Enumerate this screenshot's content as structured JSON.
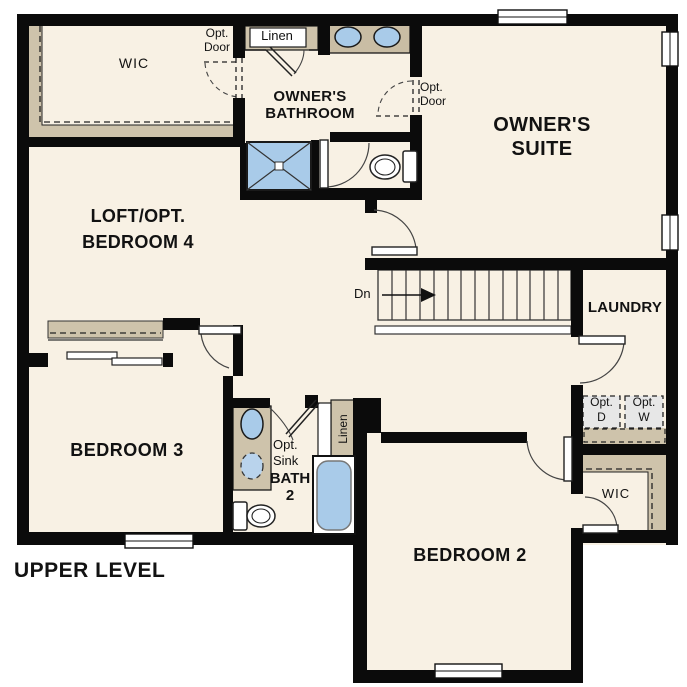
{
  "plan_title": "UPPER LEVEL",
  "colors": {
    "floor": "#f8f1e4",
    "wall": "#0b0b0b",
    "shelf_tan": "#cec3ab",
    "fixture_blue": "#a9cbe9",
    "optional_gray": "#e7e7e7",
    "outside": "#ffffff"
  },
  "rooms": {
    "wic_owners": {
      "label": "WIC"
    },
    "owners_bathroom": {
      "line1": "OWNER'S",
      "line2": "BATHROOM"
    },
    "owners_suite": {
      "line1": "OWNER'S",
      "line2": "SUITE"
    },
    "loft": {
      "line1": "LOFT/OPT.",
      "line2": "BEDROOM 4"
    },
    "laundry": {
      "label": "LAUNDRY"
    },
    "bedroom3": {
      "label": "BEDROOM 3"
    },
    "bath2": {
      "line1": "BATH",
      "line2": "2"
    },
    "bedroom2": {
      "label": "BEDROOM 2"
    },
    "wic_bedroom2": {
      "label": "WIC"
    }
  },
  "annotations": {
    "opt_door_wic": {
      "line1": "Opt.",
      "line2": "Door"
    },
    "opt_door_suite": {
      "line1": "Opt.",
      "line2": "Door"
    },
    "linen_owners": {
      "label": "Linen"
    },
    "linen_bath2": {
      "label": "Linen"
    },
    "opt_sink": {
      "line1": "Opt.",
      "line2": "Sink"
    },
    "opt_dryer": {
      "line1": "Opt.",
      "line2": "D"
    },
    "opt_washer": {
      "line1": "Opt.",
      "line2": "W"
    },
    "stairs_down": {
      "label": "Dn"
    }
  }
}
